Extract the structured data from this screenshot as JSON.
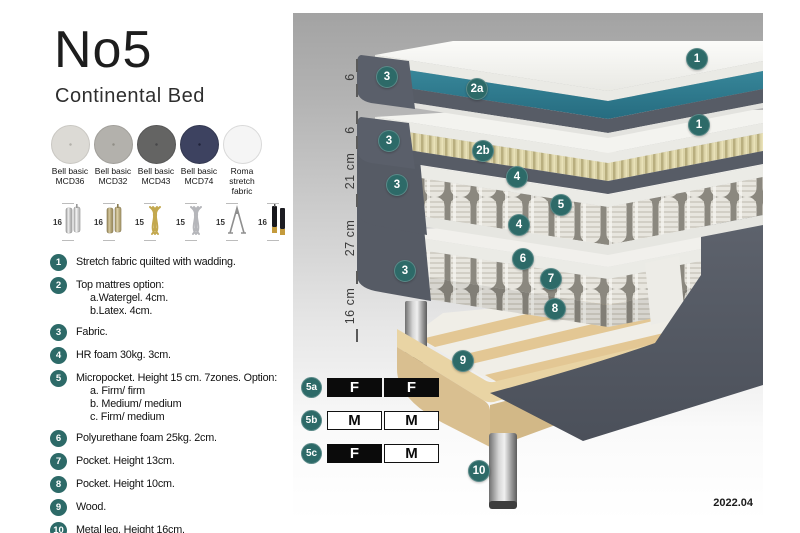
{
  "header": {
    "title": "No5",
    "subtitle": "Continental Bed"
  },
  "swatches": [
    {
      "name": "Bell basic",
      "code": "MCD36",
      "base": "#dcdad5",
      "dot": "#b3b1aa",
      "border": "#c9c7c2"
    },
    {
      "name": "Bell basic",
      "code": "MCD32",
      "base": "#b3b1ac",
      "dot": "#908e87",
      "border": "#a09e99"
    },
    {
      "name": "Bell basic",
      "code": "MCD43",
      "base": "#646463",
      "dot": "#474749",
      "border": "#565656"
    },
    {
      "name": "Bell basic",
      "code": "MCD74",
      "base": "#3d4260",
      "dot": "#20233a",
      "border": "#32374f"
    },
    {
      "name": "Roma",
      "code": "stretch fabric",
      "base": "#f5f5f5",
      "dot": "",
      "border": "#d9d9d9"
    }
  ],
  "leg_options": [
    {
      "height": "16",
      "type": "cylinder-silver"
    },
    {
      "height": "16",
      "type": "cylinder-brass"
    },
    {
      "height": "15",
      "type": "twist-gold"
    },
    {
      "height": "15",
      "type": "twist-silver"
    },
    {
      "height": "15",
      "type": "hairpin"
    },
    {
      "height": "16",
      "type": "black-gold"
    }
  ],
  "legend": [
    {
      "num": "1",
      "text": "Stretch fabric quilted with wadding."
    },
    {
      "num": "2",
      "text": "Top mattres option:",
      "subs": [
        "a.Watergel. 4cm.",
        "b.Latex. 4cm."
      ]
    },
    {
      "num": "3",
      "text": "Fabric."
    },
    {
      "num": "4",
      "text": "HR foam 30kg. 3cm."
    },
    {
      "num": "5",
      "text": "Micropocket. Height 15 cm. 7zones. Option:",
      "subs": [
        "a. Firm/ firm",
        "b. Medium/ medium",
        "c. Firm/ medium"
      ]
    },
    {
      "num": "6",
      "text": "Polyurethane foam 25kg. 2cm."
    },
    {
      "num": "7",
      "text": "Pocket. Height 13cm."
    },
    {
      "num": "8",
      "text": "Pocket. Height 10cm."
    },
    {
      "num": "9",
      "text": "Wood."
    },
    {
      "num": "10",
      "text": "Metal leg. Height 16cm."
    }
  ],
  "diagram": {
    "measurements": [
      {
        "label": "6",
        "y": 64
      },
      {
        "label": "6",
        "y": 117
      },
      {
        "label": "21 cm",
        "y": 158
      },
      {
        "label": "27 cm",
        "y": 225
      },
      {
        "label": "16 cm",
        "y": 293
      }
    ],
    "ticks": [
      52,
      77,
      104,
      129,
      187,
      264,
      322
    ],
    "badges": [
      {
        "label": "1",
        "x": 404,
        "y": 46
      },
      {
        "label": "2a",
        "x": 184,
        "y": 76
      },
      {
        "label": "3",
        "x": 94,
        "y": 64
      },
      {
        "label": "1",
        "x": 406,
        "y": 112
      },
      {
        "label": "2b",
        "x": 190,
        "y": 138
      },
      {
        "label": "3",
        "x": 96,
        "y": 128
      },
      {
        "label": "4",
        "x": 224,
        "y": 164
      },
      {
        "label": "5",
        "x": 268,
        "y": 192
      },
      {
        "label": "4",
        "x": 226,
        "y": 212
      },
      {
        "label": "3",
        "x": 104,
        "y": 172
      },
      {
        "label": "6",
        "x": 230,
        "y": 246
      },
      {
        "label": "7",
        "x": 258,
        "y": 266
      },
      {
        "label": "8",
        "x": 262,
        "y": 296
      },
      {
        "label": "3",
        "x": 112,
        "y": 258
      },
      {
        "label": "9",
        "x": 170,
        "y": 348
      },
      {
        "label": "10",
        "x": 186,
        "y": 458
      }
    ]
  },
  "firmness_table": {
    "rows": [
      {
        "id": "5a",
        "top": 364,
        "cells": [
          {
            "t": "F",
            "dark": true
          },
          {
            "t": "F",
            "dark": true
          }
        ]
      },
      {
        "id": "5b",
        "top": 397,
        "cells": [
          {
            "t": "M",
            "dark": false
          },
          {
            "t": "M",
            "dark": false
          }
        ]
      },
      {
        "id": "5c",
        "top": 430,
        "cells": [
          {
            "t": "F",
            "dark": true
          },
          {
            "t": "M",
            "dark": false
          }
        ]
      }
    ]
  },
  "footer": {
    "version": "2022.04"
  },
  "colors": {
    "badge_teal": "#2d6a68",
    "layer_teal": "#2f7e92",
    "upholstery_gray": "#575c66",
    "latex_beige": "#dbd3a8",
    "wood": "#e9d4a4"
  }
}
